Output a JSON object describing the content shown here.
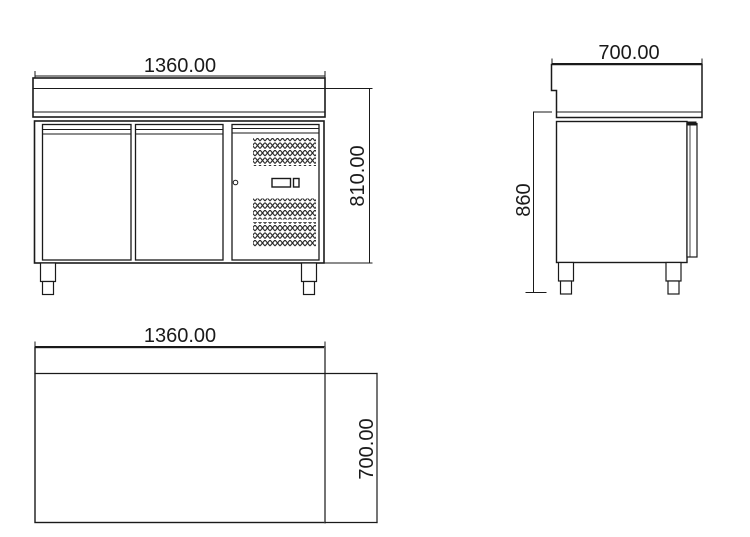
{
  "views": {
    "front": {
      "width_dim": "1360.00",
      "height_dim": "810.00"
    },
    "side": {
      "depth_dim": "700.00",
      "height_dim": "860"
    },
    "plan": {
      "width_dim": "1360.00",
      "depth_dim": "700.00"
    }
  }
}
